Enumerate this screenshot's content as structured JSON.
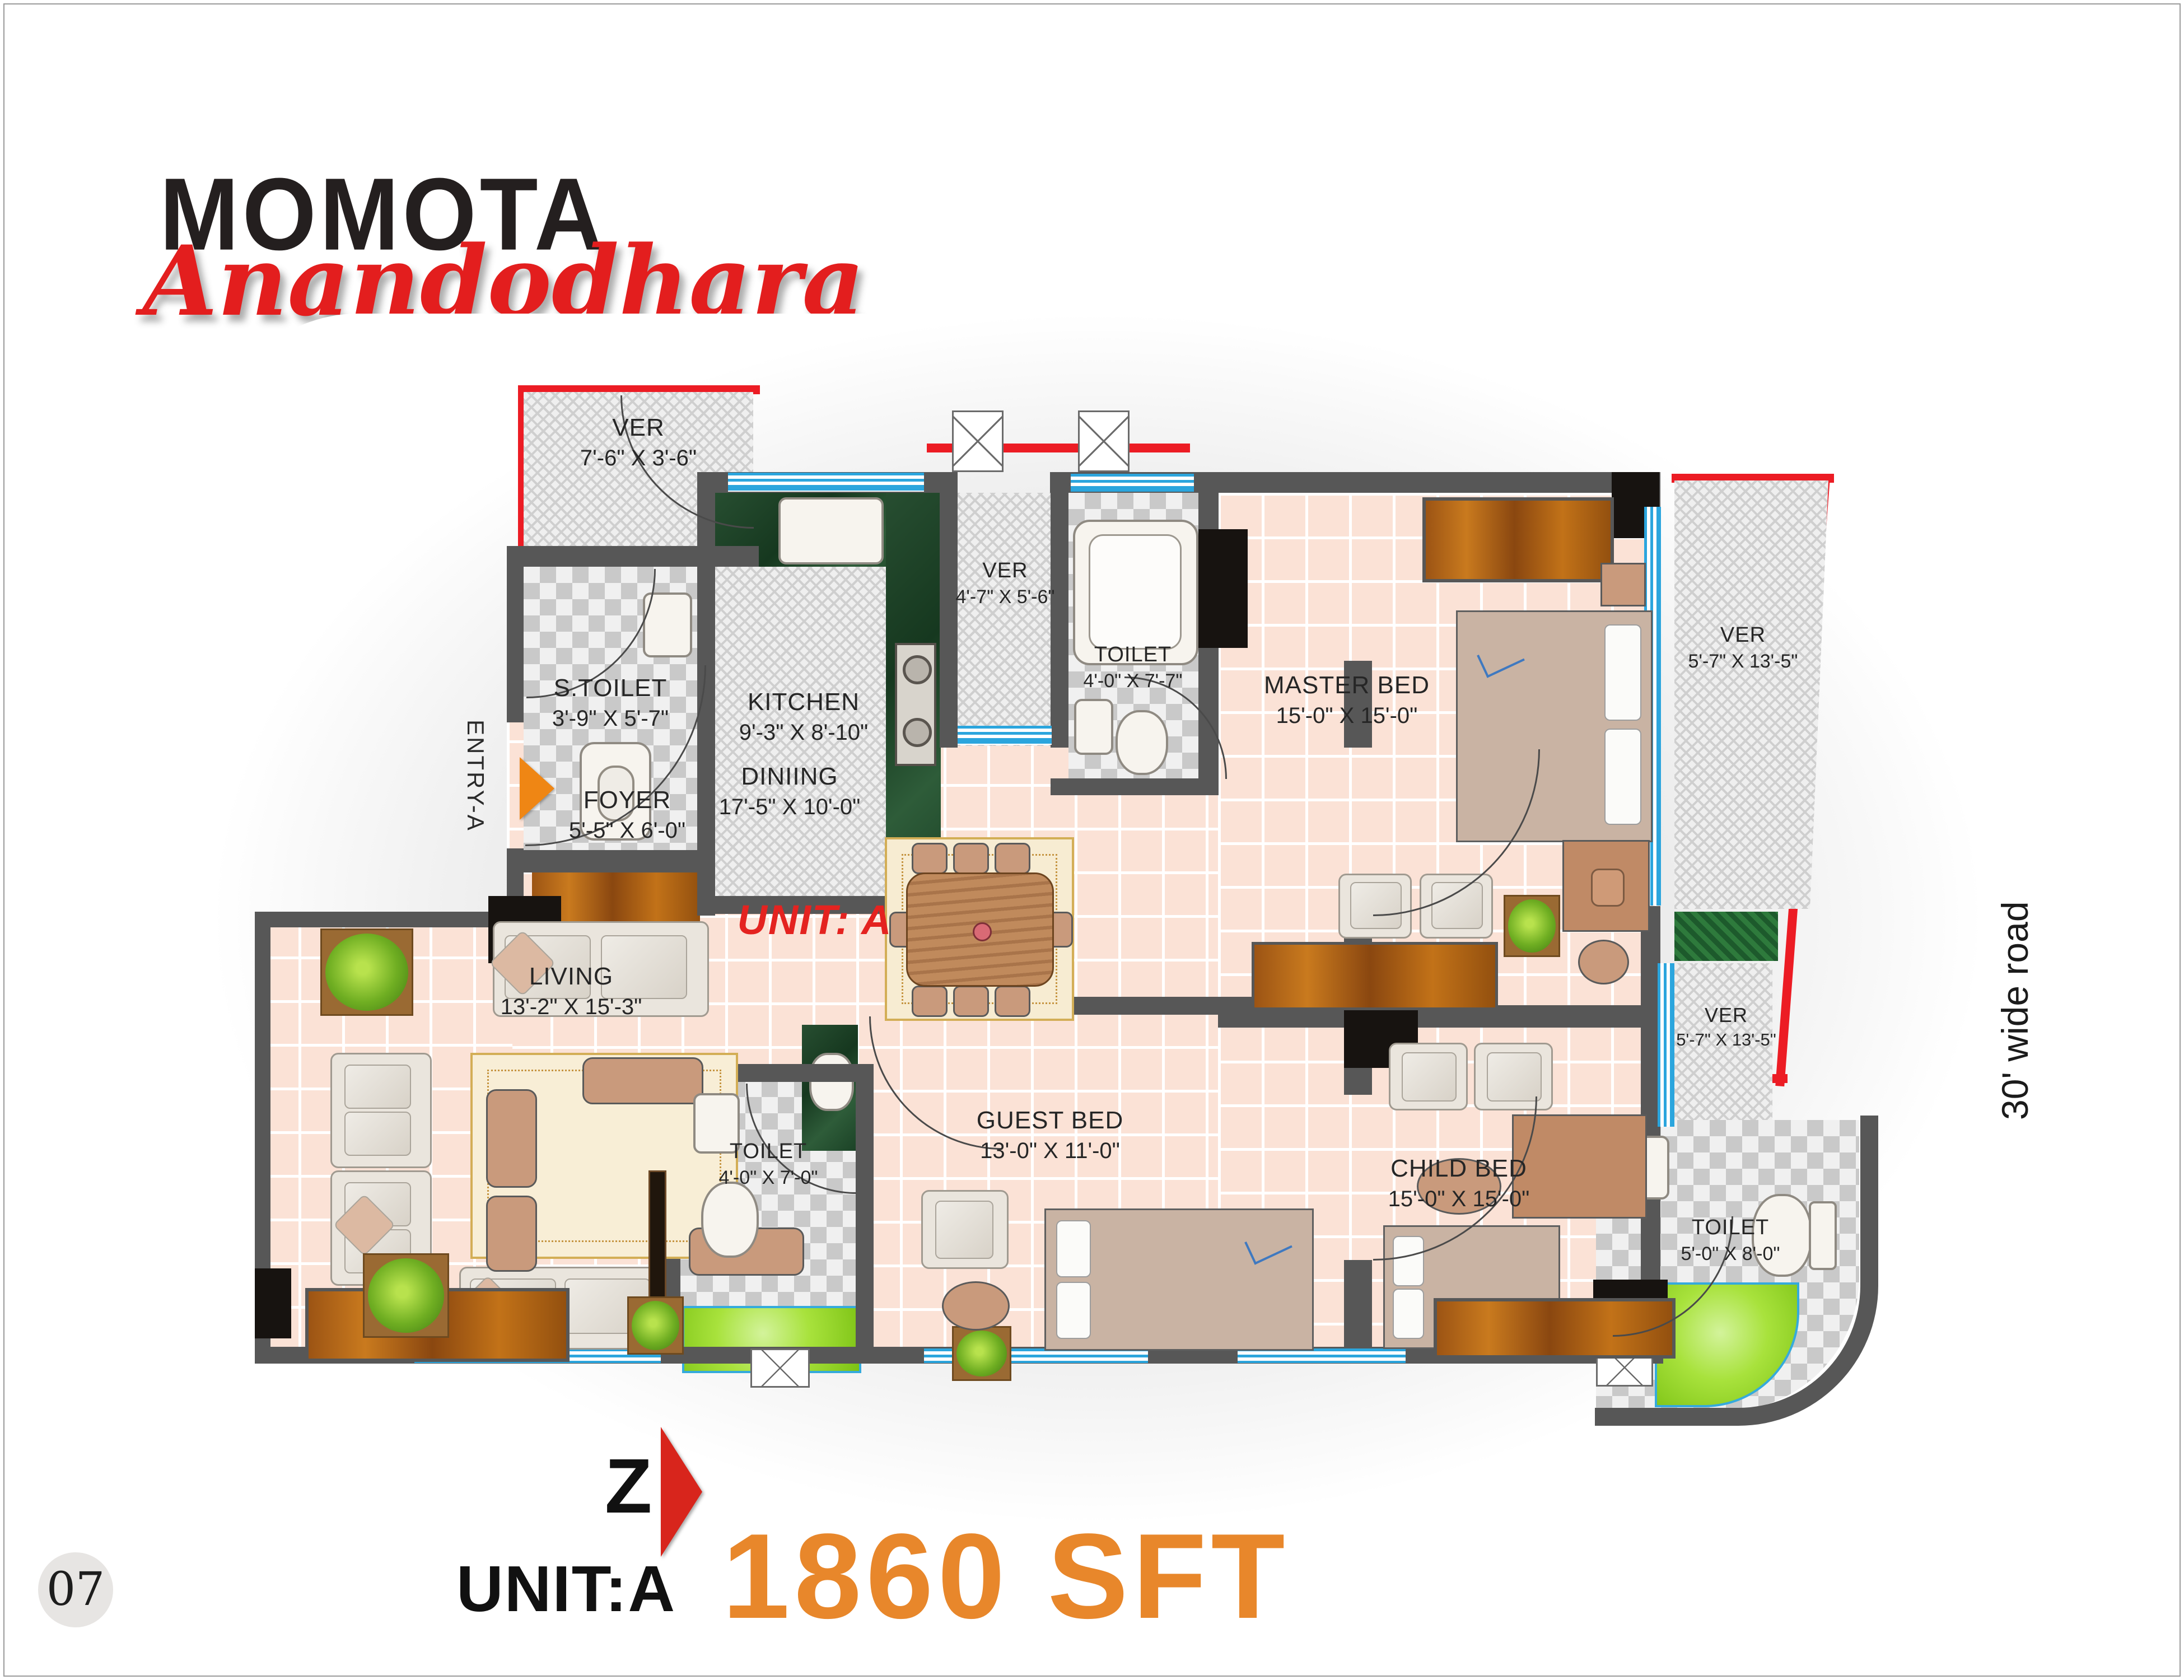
{
  "brand": {
    "title": "MOMOTA",
    "subtitle": "Anandodhara"
  },
  "plan": {
    "unit_label": "UNIT: A",
    "entry_label": "ENTRY-A",
    "road_label": "30' wide road",
    "rooms": {
      "ver_top_left": {
        "name": "VER",
        "dims": "7'-6\" X 3'-6\""
      },
      "s_toilet": {
        "name": "S.TOILET",
        "dims": "3'-9\" X 5'-7\""
      },
      "kitchen": {
        "name": "KITCHEN",
        "dims": "9'-3\" X 8'-10\""
      },
      "ver_kitchen": {
        "name": "VER",
        "dims": "4'-7\" X 5'-6\""
      },
      "toilet_master": {
        "name": "TOILET",
        "dims": "4'-0\" X 7'-7\""
      },
      "master_bed": {
        "name": "MASTER BED",
        "dims": "15'-0\" X 15'-0\""
      },
      "ver_right_top": {
        "name": "VER",
        "dims": "5'-7\" X 13'-5\""
      },
      "ver_right_bottom": {
        "name": "VER",
        "dims": "5'-7\" X 13'-5\""
      },
      "foyer": {
        "name": "FOYER",
        "dims": "5'-5\" X 6'-0\""
      },
      "dining": {
        "name": "DINIING",
        "dims": "17'-5\" X 10'-0\""
      },
      "living": {
        "name": "LIVING",
        "dims": "13'-2\" X 15'-3\""
      },
      "toilet_guest": {
        "name": "TOILET",
        "dims": "4'-0\" X 7'-0\""
      },
      "guest_bed": {
        "name": "GUEST BED",
        "dims": "13'-0\" X 11'-0\""
      },
      "child_bed": {
        "name": "CHILD BED",
        "dims": "15'-0\" X 15'-0\""
      },
      "toilet_child": {
        "name": "TOILET",
        "dims": "5'-0\" X 8'-0\""
      }
    }
  },
  "footer": {
    "compass_letter": "Z",
    "unit_label": "UNIT:A",
    "area_label": "1860 SFT"
  },
  "page_number": "07",
  "colors": {
    "boundary_red": "#ec1c24",
    "accent_orange": "#e8872b",
    "logo_red": "#e31e1e",
    "window_blue": "#2ba5dd",
    "wall_gray": "#575757",
    "floor_pink": "#fbe2d6",
    "lawn_green": "#a8e23c"
  }
}
